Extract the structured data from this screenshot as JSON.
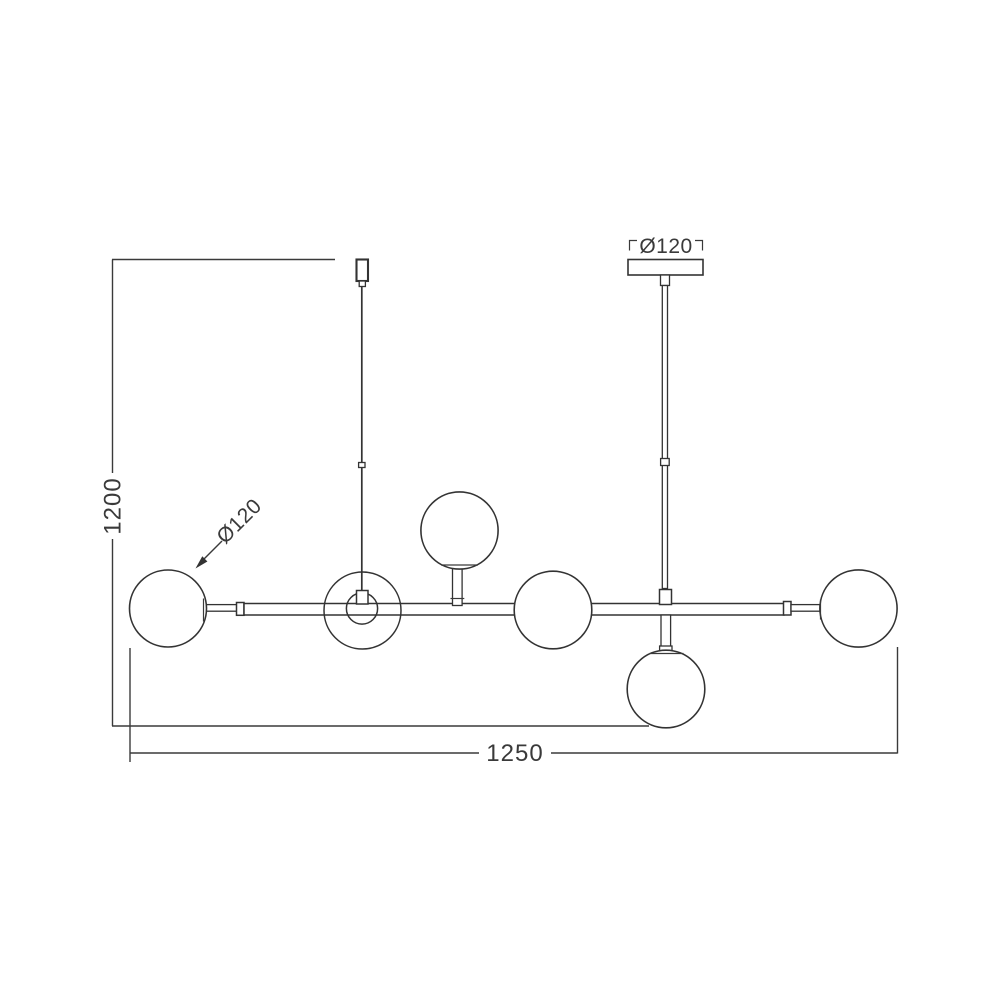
{
  "drawing": {
    "product": "six-globe-pendant-lamp-technical-drawing",
    "line_color": "#333333",
    "background_color": "#ffffff",
    "dimensions": {
      "overall_height": "1200",
      "overall_width": "1250",
      "canopy_diameter": "Ø120",
      "globe_diameter": "Ø120"
    }
  }
}
